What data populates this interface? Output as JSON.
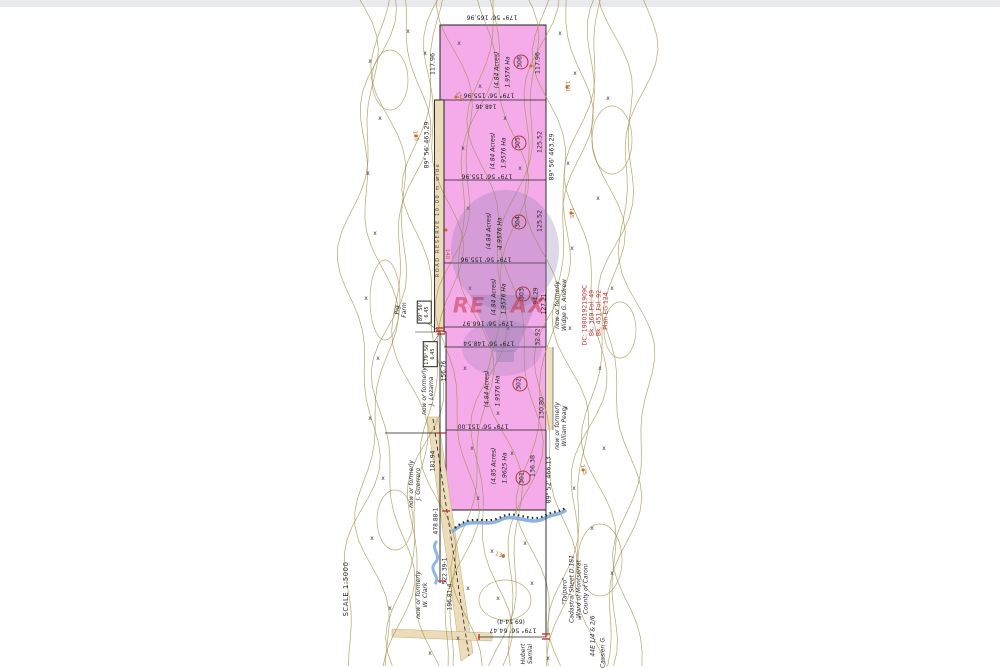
{
  "document": {
    "type_hint": "cadastral survey plan",
    "scale_label": "SCALE  1:5000",
    "watermark": {
      "left": "RE",
      "right": "AX"
    }
  },
  "colors": {
    "lot_fill": "#f5abe9",
    "road_fill": "#ecdcba",
    "contour": "#a19049",
    "stream": "#85aede",
    "boundary": "#1f1f1f",
    "survey_red": "#c32222",
    "watermark_purple": "#8d7ab0",
    "watermark_red": "#c42a40",
    "reference_red": "#c03030"
  },
  "lots": [
    {
      "number": "306",
      "area_ha": "1.9576 Ha",
      "area_acres": "(4.84 Acres)"
    },
    {
      "number": "305",
      "area_ha": "1.9576 Ha",
      "area_acres": "(4.84 Acres)"
    },
    {
      "number": "304",
      "area_ha": "1.9576 Ha",
      "area_acres": "(4.84 Acres)"
    },
    {
      "number": "303",
      "area_ha": "1.9576 Ha",
      "area_acres": "(4.84 Acres)"
    },
    {
      "number": "302",
      "area_ha": "1.9576 Ha",
      "area_acres": "(4.84 Acres)"
    },
    {
      "number": "301",
      "area_ha": "1.9625 Ha",
      "area_acres": "(4.85 Acres)"
    }
  ],
  "map_labels": [
    {
      "name": "dim-top-boundary",
      "text": "179° 56'   165.96",
      "x": 492,
      "y": 17,
      "rot": 180,
      "cls": "dim"
    },
    {
      "name": "dim-divider-1",
      "text": "179° 56'   155.96",
      "x": 489,
      "y": 95,
      "rot": 180,
      "cls": "dim"
    },
    {
      "name": "dim-divider-1b",
      "text": "148.46",
      "x": 486,
      "y": 106,
      "rot": 180,
      "cls": "sub"
    },
    {
      "name": "dim-divider-2",
      "text": "179° 56'   155.96",
      "x": 487,
      "y": 176,
      "rot": 180,
      "cls": "dim"
    },
    {
      "name": "dim-divider-3",
      "text": "179° 56'   155.96",
      "x": 486,
      "y": 259,
      "rot": 180,
      "cls": "dim"
    },
    {
      "name": "dim-divider-4",
      "text": "179° 56'   166.97",
      "x": 488,
      "y": 323,
      "rot": 180,
      "cls": "dim"
    },
    {
      "name": "dim-divider-5",
      "text": "179° 56'   148.54",
      "x": 489,
      "y": 343,
      "rot": 180,
      "cls": "dim"
    },
    {
      "name": "dim-divider-6",
      "text": "179° 56'   151.00",
      "x": 483,
      "y": 426,
      "rot": 180,
      "cls": "dim"
    },
    {
      "name": "dim-bottom",
      "text": "179° 56'   64.47",
      "x": 513,
      "y": 630,
      "rot": 180,
      "cls": "dim"
    },
    {
      "name": "dim-bottom-alt",
      "text": "(69.54-4)",
      "x": 511,
      "y": 621,
      "rot": 180,
      "cls": "sub"
    },
    {
      "name": "dim-left-11796",
      "text": "117.96",
      "x": 433,
      "y": 64,
      "rot": -90,
      "cls": "dim"
    },
    {
      "name": "dim-right-11796",
      "text": "117.96",
      "x": 538,
      "y": 63,
      "rot": -90,
      "cls": "dim"
    },
    {
      "name": "dim-left-46329",
      "text": "89° 56'   463.29",
      "x": 427,
      "y": 145,
      "rot": -90,
      "cls": "dim"
    },
    {
      "name": "dim-right-46329",
      "text": "89° 56'   463.29",
      "x": 552,
      "y": 157,
      "rot": -90,
      "cls": "dim"
    },
    {
      "name": "dim-right-12552a",
      "text": "125.52",
      "x": 540,
      "y": 142,
      "rot": -90,
      "cls": "dim"
    },
    {
      "name": "dim-right-12552b",
      "text": "125.52",
      "x": 540,
      "y": 221,
      "rot": -90,
      "cls": "dim"
    },
    {
      "name": "dim-right-9429",
      "text": "94.29",
      "x": 536,
      "y": 296,
      "rot": -90,
      "cls": "sub"
    },
    {
      "name": "dim-right-12721",
      "text": "127.21",
      "x": 544,
      "y": 304,
      "rot": -90,
      "cls": "sub"
    },
    {
      "name": "dim-right-3292",
      "text": "32.92",
      "x": 538,
      "y": 337,
      "rot": -90,
      "cls": "sub"
    },
    {
      "name": "dim-right-13080",
      "text": "130.80",
      "x": 542,
      "y": 408,
      "rot": -90,
      "cls": "dim"
    },
    {
      "name": "dim-right-13638",
      "text": "136.38",
      "x": 533,
      "y": 466,
      "rot": -90,
      "cls": "dim"
    },
    {
      "name": "dim-right-46613",
      "text": "89° 52'   466.13",
      "x": 549,
      "y": 480,
      "rot": -90,
      "cls": "dim"
    },
    {
      "name": "dim-left-15676",
      "text": "156.76",
      "x": 444,
      "y": 371,
      "rot": -90,
      "cls": "sub"
    },
    {
      "name": "dim-left-18194",
      "text": "181.94",
      "x": 433,
      "y": 461,
      "rot": -90,
      "cls": "sub"
    },
    {
      "name": "dim-left-47888",
      "text": "478.88-1",
      "x": 436,
      "y": 521,
      "rot": -90,
      "cls": "sub"
    },
    {
      "name": "dim-left-52239",
      "text": "522.39-1",
      "x": 445,
      "y": 571,
      "rot": -90,
      "cls": "sub"
    },
    {
      "name": "dim-left-19681",
      "text": "196.81-4",
      "x": 450,
      "y": 597,
      "rot": -90,
      "cls": "sub"
    },
    {
      "name": "road-reserve-label",
      "text": "ROAD RESERVE  10.00 m  wide",
      "x": 439,
      "y": 220,
      "rot": -90,
      "cls": "roadres"
    },
    {
      "name": "owner-pig-farm",
      "text": "Pig|Farm",
      "x": 401,
      "y": 310,
      "rot": -90,
      "cls": "name"
    },
    {
      "name": "owner-lezama",
      "text": "now or formerly|J. Lezama",
      "x": 428,
      "y": 391,
      "rot": -90,
      "cls": "name"
    },
    {
      "name": "owner-guerrero",
      "text": "now or formerly|J. Guerrero",
      "x": 415,
      "y": 484,
      "rot": -90,
      "cls": "name"
    },
    {
      "name": "owner-clark",
      "text": "now or formerly|W. Clark",
      "x": 422,
      "y": 595,
      "rot": -90,
      "cls": "name"
    },
    {
      "name": "owner-andrew",
      "text": "now or formerly|Widge G. Andrew",
      "x": 561,
      "y": 305,
      "rot": -90,
      "cls": "name"
    },
    {
      "name": "owner-peary",
      "text": "now or formerly|William Peary",
      "x": 561,
      "y": 426,
      "rot": -90,
      "cls": "name"
    },
    {
      "name": "owner-hubert",
      "text": "Hubert|Samlal",
      "x": 527,
      "y": 654,
      "rot": -90,
      "cls": "name"
    },
    {
      "name": "cadastral-block",
      "text": "Cadastral Sheet   D.181|Ward of Montserrat|County of Caroni",
      "x": 579,
      "y": 589,
      "rot": -90,
      "cls": "name"
    },
    {
      "name": "place-talparo",
      "text": "\"Talparo\"",
      "x": 565,
      "y": 591,
      "rot": -90,
      "cls": "name"
    },
    {
      "name": "owner-cassieri",
      "text": "Cassieri  G.",
      "x": 603,
      "y": 652,
      "rot": -90,
      "cls": "name"
    },
    {
      "name": "sheet-ref",
      "text": "44E  1/4 & 2/6",
      "x": 593,
      "y": 636,
      "rot": -90,
      "cls": "name"
    },
    {
      "name": "scale-label",
      "text": "SCALE  1:5000",
      "x": 346,
      "y": 589,
      "rot": -90,
      "cls": "scale"
    },
    {
      "name": "ref-dc",
      "text": "DC: 19801921909C",
      "x": 585,
      "y": 315,
      "rot": -90,
      "cls": "red"
    },
    {
      "name": "ref-bk-369",
      "text": "Bk.  369  Fol.  49",
      "x": 592,
      "y": 313,
      "rot": -90,
      "cls": "red"
    },
    {
      "name": "ref-bk-451",
      "text": "Bk.  451  Fol.  92",
      "x": 599,
      "y": 313,
      "rot": -90,
      "cls": "red"
    },
    {
      "name": "ref-plan",
      "text": "Plan  EG  124",
      "x": 606,
      "y": 311,
      "rot": -90,
      "cls": "red"
    },
    {
      "name": "box-8956-645",
      "text": "89° 56'|6.45",
      "x": 424,
      "y": 312,
      "rot": -90,
      "cls": "boxed"
    },
    {
      "name": "box-17956-645",
      "text": "179° 56'|6.45",
      "x": 430,
      "y": 354,
      "rot": -90,
      "cls": "boxed"
    },
    {
      "name": "lot306-area-ha",
      "text": "1.9576 Ha",
      "x": 508,
      "y": 72,
      "rot": -90,
      "cls": "area"
    },
    {
      "name": "lot306-area-ac",
      "text": "(4.84 Acres)",
      "x": 497,
      "y": 70,
      "rot": -90,
      "cls": "area"
    },
    {
      "name": "lot305-area-ha",
      "text": "1.9576 Ha",
      "x": 504,
      "y": 153,
      "rot": -90,
      "cls": "area"
    },
    {
      "name": "lot305-area-ac",
      "text": "(4.84 Acres)",
      "x": 493,
      "y": 151,
      "rot": -90,
      "cls": "area"
    },
    {
      "name": "lot304-area-ha",
      "text": "1.9576 Ha",
      "x": 500,
      "y": 233,
      "rot": -90,
      "cls": "area"
    },
    {
      "name": "lot304-area-ac",
      "text": "(4.84 Acres)",
      "x": 489,
      "y": 231,
      "rot": -90,
      "cls": "area"
    },
    {
      "name": "lot303-area-ha",
      "text": "1.9576 Ha",
      "x": 504,
      "y": 299,
      "rot": -90,
      "cls": "area"
    },
    {
      "name": "lot303-area-ac",
      "text": "(4.84 Acres)",
      "x": 494,
      "y": 297,
      "rot": -90,
      "cls": "area"
    },
    {
      "name": "lot302-area-ha",
      "text": "1.9576 Ha",
      "x": 498,
      "y": 391,
      "rot": -90,
      "cls": "area"
    },
    {
      "name": "lot302-area-ac",
      "text": "(4.84 Acres)",
      "x": 487,
      "y": 389,
      "rot": -90,
      "cls": "area"
    },
    {
      "name": "lot301-area-ha",
      "text": "1.9625 Ha",
      "x": 505,
      "y": 468,
      "rot": -90,
      "cls": "area"
    },
    {
      "name": "lot301-area-ac",
      "text": "(4.85 Acres)",
      "x": 494,
      "y": 466,
      "rot": -90,
      "cls": "area"
    },
    {
      "name": "lot306-number",
      "text": "306",
      "x": 521,
      "y": 62,
      "rot": -90,
      "cls": "lotnum"
    },
    {
      "name": "lot305-number",
      "text": "305",
      "x": 519,
      "y": 143,
      "rot": -90,
      "cls": "lotnum"
    },
    {
      "name": "lot304-number",
      "text": "304",
      "x": 519,
      "y": 222,
      "rot": -90,
      "cls": "lotnum"
    },
    {
      "name": "lot303-number",
      "text": "303",
      "x": 523,
      "y": 294,
      "rot": -90,
      "cls": "lotnum"
    },
    {
      "name": "lot302-number",
      "text": "302",
      "x": 520,
      "y": 384,
      "rot": -90,
      "cls": "lotnum"
    },
    {
      "name": "lot301-number",
      "text": "301",
      "x": 523,
      "y": 478,
      "rot": -90,
      "cls": "lotnum"
    },
    {
      "name": "contour-150a",
      "text": "150",
      "x": 459,
      "y": 97,
      "rot": 60,
      "cls": "clabel"
    },
    {
      "name": "contour-150b",
      "text": "150",
      "x": 567,
      "y": 86,
      "rot": 90,
      "cls": "clabel"
    },
    {
      "name": "contour-145",
      "text": "145",
      "x": 571,
      "y": 213,
      "rot": 90,
      "cls": "clabel"
    },
    {
      "name": "contour-140",
      "text": "140",
      "x": 447,
      "y": 254,
      "rot": 90,
      "cls": "clabel"
    },
    {
      "name": "contour-135",
      "text": "135",
      "x": 583,
      "y": 470,
      "rot": 75,
      "cls": "clabel"
    },
    {
      "name": "contour-130",
      "text": "130",
      "x": 500,
      "y": 556,
      "rot": 20,
      "cls": "clabel"
    },
    {
      "name": "contour-125",
      "text": "125",
      "x": 415,
      "y": 136,
      "rot": 80,
      "cls": "clabel"
    },
    {
      "name": "watermark-re",
      "text": "RE",
      "x": 469,
      "y": 306,
      "rot": 0,
      "cls": "wm"
    },
    {
      "name": "watermark-ax",
      "text": "AX",
      "x": 528,
      "y": 306,
      "rot": 0,
      "cls": "wm"
    }
  ]
}
